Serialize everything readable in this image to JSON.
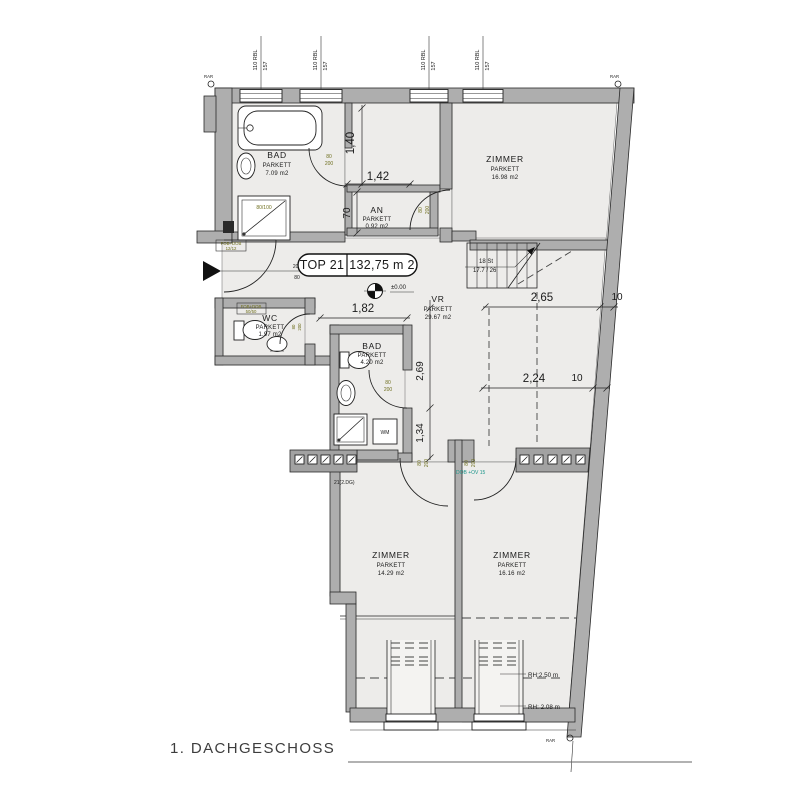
{
  "title": "1. DACHGESCHOSS",
  "badge": {
    "unit": "TOP 21",
    "area": "132,75 m 2"
  },
  "level": {
    "value": "±0.00"
  },
  "rooms": {
    "bad1": {
      "name": "BAD",
      "finish": "PARKETT",
      "area": "7.09 m2"
    },
    "an": {
      "name": "AN",
      "finish": "PARKETT",
      "area": "0.92 m2"
    },
    "zimmer1": {
      "name": "ZIMMER",
      "finish": "PARKETT",
      "area": "16.98 m2"
    },
    "wc": {
      "name": "WC",
      "finish": "PARKETT",
      "area": "1.97 m2"
    },
    "vr": {
      "name": "VR",
      "finish": "PARKETT",
      "area": "29.67 m2"
    },
    "bad2": {
      "name": "BAD",
      "finish": "PARKETT",
      "area": "4.20 m2"
    },
    "zimmer2": {
      "name": "ZIMMER",
      "finish": "PARKETT",
      "area": "14.29 m2"
    },
    "zimmer3": {
      "name": "ZIMMER",
      "finish": "PARKETT",
      "area": "16.16 m2"
    }
  },
  "dims": {
    "v140": "1,40",
    "h142": "1,42",
    "v70": "70",
    "h182": "1,82",
    "h265": "2,65",
    "h265w": "10",
    "h224": "2,24",
    "h224w": "10",
    "v269": "2,69",
    "v134": "1,34"
  },
  "stairs": {
    "steps": "18 St",
    "ratio": "17.7 / 26"
  },
  "roof_heights": {
    "rh1": "RH:2.50 m",
    "rh2": "RH: 2.08 m"
  },
  "window_tag": {
    "l1": "110 RBL",
    "l2": "157"
  },
  "doors": {
    "w": "80",
    "h": "200",
    "entry_top": "200",
    "entry_bottom": "80",
    "shower": "80/100"
  },
  "notes": {
    "floor_ref": "21(2.DG)",
    "beam": "DOB +OV 15",
    "wm": "WM",
    "fob": "FOB+DOB",
    "fob1": "12/12",
    "fob2": "50/50",
    "corner": "RAR"
  },
  "colors": {
    "wall": "#aeaeae",
    "room": "#edecea",
    "olive": "#6f6f1f",
    "teal": "#1a958a",
    "ink": "#1a1a1a"
  }
}
